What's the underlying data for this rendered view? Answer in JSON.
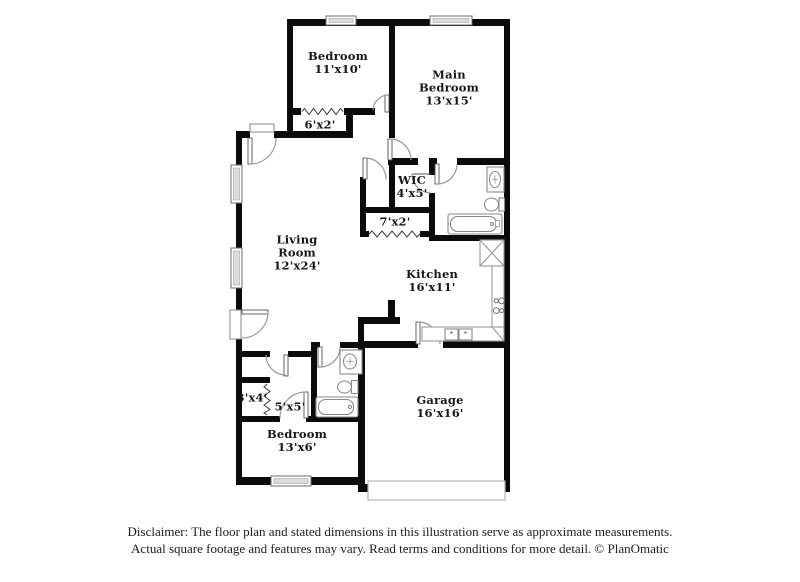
{
  "rooms": {
    "bedroom1": {
      "name": "Bedroom",
      "dims": "11'x10'"
    },
    "main_bedroom": {
      "name": "Main Bedroom",
      "dims": "13'x15'"
    },
    "closet_6x2": {
      "dims": "6'x2'"
    },
    "wic": {
      "name": "WIC",
      "dims": "4'x5'"
    },
    "closet_7x2": {
      "dims": "7'x2'"
    },
    "living_room": {
      "name": "Living Room",
      "dims": "12'x24'"
    },
    "kitchen": {
      "name": "Kitchen",
      "dims": "16'x11'"
    },
    "closet_3x4": {
      "dims": "3'x4'"
    },
    "hall_5x5": {
      "dims": "5'x5'"
    },
    "bedroom2": {
      "name": "Bedroom",
      "dims": "13'x6'"
    },
    "garage": {
      "name": "Garage",
      "dims": "16'x16'"
    }
  },
  "disclaimer": {
    "line1": "Disclaimer: The floor plan and stated dimensions in this illustration serve as approximate measurements.",
    "line2": "Actual square footage and features may vary. Read terms and conditions for more detail. © PlanOmatic"
  },
  "colors": {
    "wall": "#0b0b0b",
    "door_arc": "#9a9a9a",
    "fixture_stroke": "#8a8a8a",
    "window_frame": "#6e6e6e",
    "text": "#161616"
  }
}
